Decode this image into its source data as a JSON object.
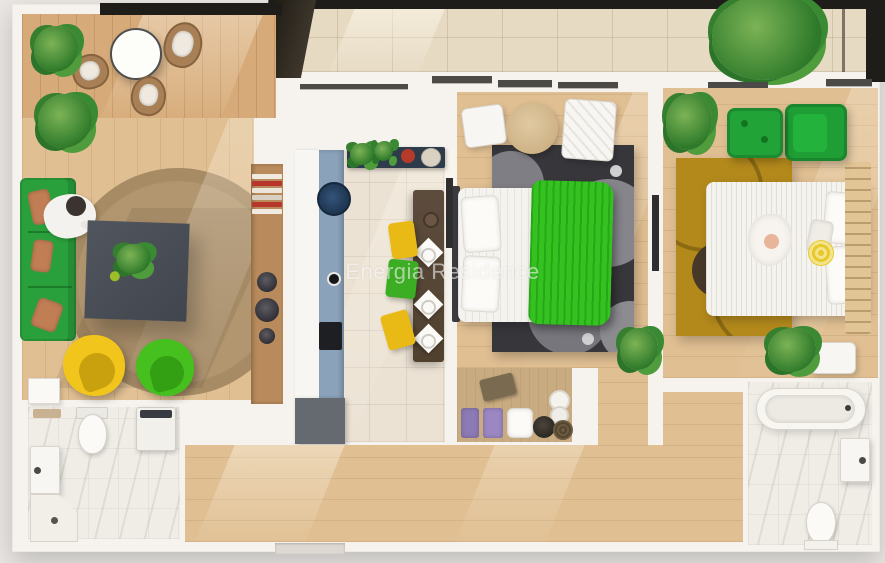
{
  "watermark": {
    "text": "Energia Residence"
  },
  "scene": {
    "type": "3d-floorplan-top-view-render",
    "description": "Photorealistic top-down render of a two-bedroom apartment with terrace, watermarked Energia Residence",
    "rooms": [
      {
        "id": "balcony-left",
        "floor": "wood-deck",
        "furniture": [
          "round-bistro-table",
          "wicker-chair",
          "wicker-chair",
          "wicker-chair",
          "potted-plant",
          "potted-plant"
        ]
      },
      {
        "id": "terrace-top",
        "floor": "beige-tile",
        "furniture": [
          "large-potted-plant"
        ],
        "edge": "dark-railing"
      },
      {
        "id": "living-room",
        "floor": "light-wood",
        "furniture": [
          "green-sofa",
          "terracotta-pillows",
          "seated-person",
          "square-coffee-table",
          "table-plant",
          "round-jute-rug",
          "yellow-egg-chair",
          "green-egg-chair",
          "bookshelf-with-books",
          "decor-bowls"
        ]
      },
      {
        "id": "kitchen",
        "floor": "beige-tile",
        "furniture": [
          "white-counter",
          "blue-cabinet-run",
          "round-sink",
          "cooktop",
          "grey-base-cabinet",
          "herb-shelf",
          "dark-dining-table",
          "plates",
          "yellow-chair",
          "green-chair",
          "yellow-chair"
        ]
      },
      {
        "id": "bedroom-1",
        "floor": "light-wood",
        "furniture": [
          "double-bed-white-sheets",
          "green-striped-blanket",
          "pillows",
          "dark-circle-rug",
          "white-pouf",
          "white-pouf",
          "round-wood-side-table",
          "potted-plant",
          "wall-tv"
        ]
      },
      {
        "id": "closet-nook",
        "floor": "tan-carpet",
        "furniture": [
          "storage-basket",
          "toilet-paper-rolls",
          "purple-towels",
          "white-pillow",
          "dark-bowl",
          "woven-basket"
        ]
      },
      {
        "id": "bedroom-2",
        "floor": "light-wood",
        "furniture": [
          "double-bed-white-striped",
          "baby-on-bed",
          "pineapple-pillow",
          "mustard-circle-rug",
          "green-armchair",
          "green-ottoman",
          "wood-slat-headboard",
          "potted-plant",
          "floor-plants",
          "white-side-table",
          "wall-tv"
        ]
      },
      {
        "id": "bathroom-1",
        "floor": "marble",
        "furniture": [
          "toilet",
          "washing-machine",
          "sink-vanity",
          "corner-shower",
          "door-leaf"
        ]
      },
      {
        "id": "bathroom-2",
        "floor": "marble",
        "furniture": [
          "bathtub",
          "sink-vanity",
          "toilet"
        ]
      },
      {
        "id": "hallway",
        "floor": "light-wood",
        "furniture": [
          "entry-threshold"
        ]
      }
    ]
  },
  "colors": {
    "background": "#e9e6e3",
    "walls": "#f6f3ee",
    "railing": "#1e1d1a",
    "wood_floor": "#e0bf92",
    "deck_wood": "#d7ab79",
    "terrace_tile": "#e6dac3",
    "kitchen_tile": "#ebe2d4",
    "marble": "#f0ede7",
    "sofa_green": "#2aa03c",
    "egg_chair_yellow": "#f2c51d",
    "egg_chair_green": "#46c01e",
    "blanket_green": "#35c220",
    "armchair_green": "#1f9e35",
    "dining_chair_yellow": "#e9ba16",
    "dining_chair_green": "#3cae24",
    "rug_jute": "#b59a74",
    "rug_dark": "#37373b",
    "rug_mustard": "#b3891c",
    "cabinet_blue": "#8aa2ba",
    "sink_navy": "#223c55",
    "coffee_table_grey": "#474c54",
    "pillow_terracotta": "#c17d54",
    "watermark_text": "rgba(255,255,255,0.55)"
  }
}
